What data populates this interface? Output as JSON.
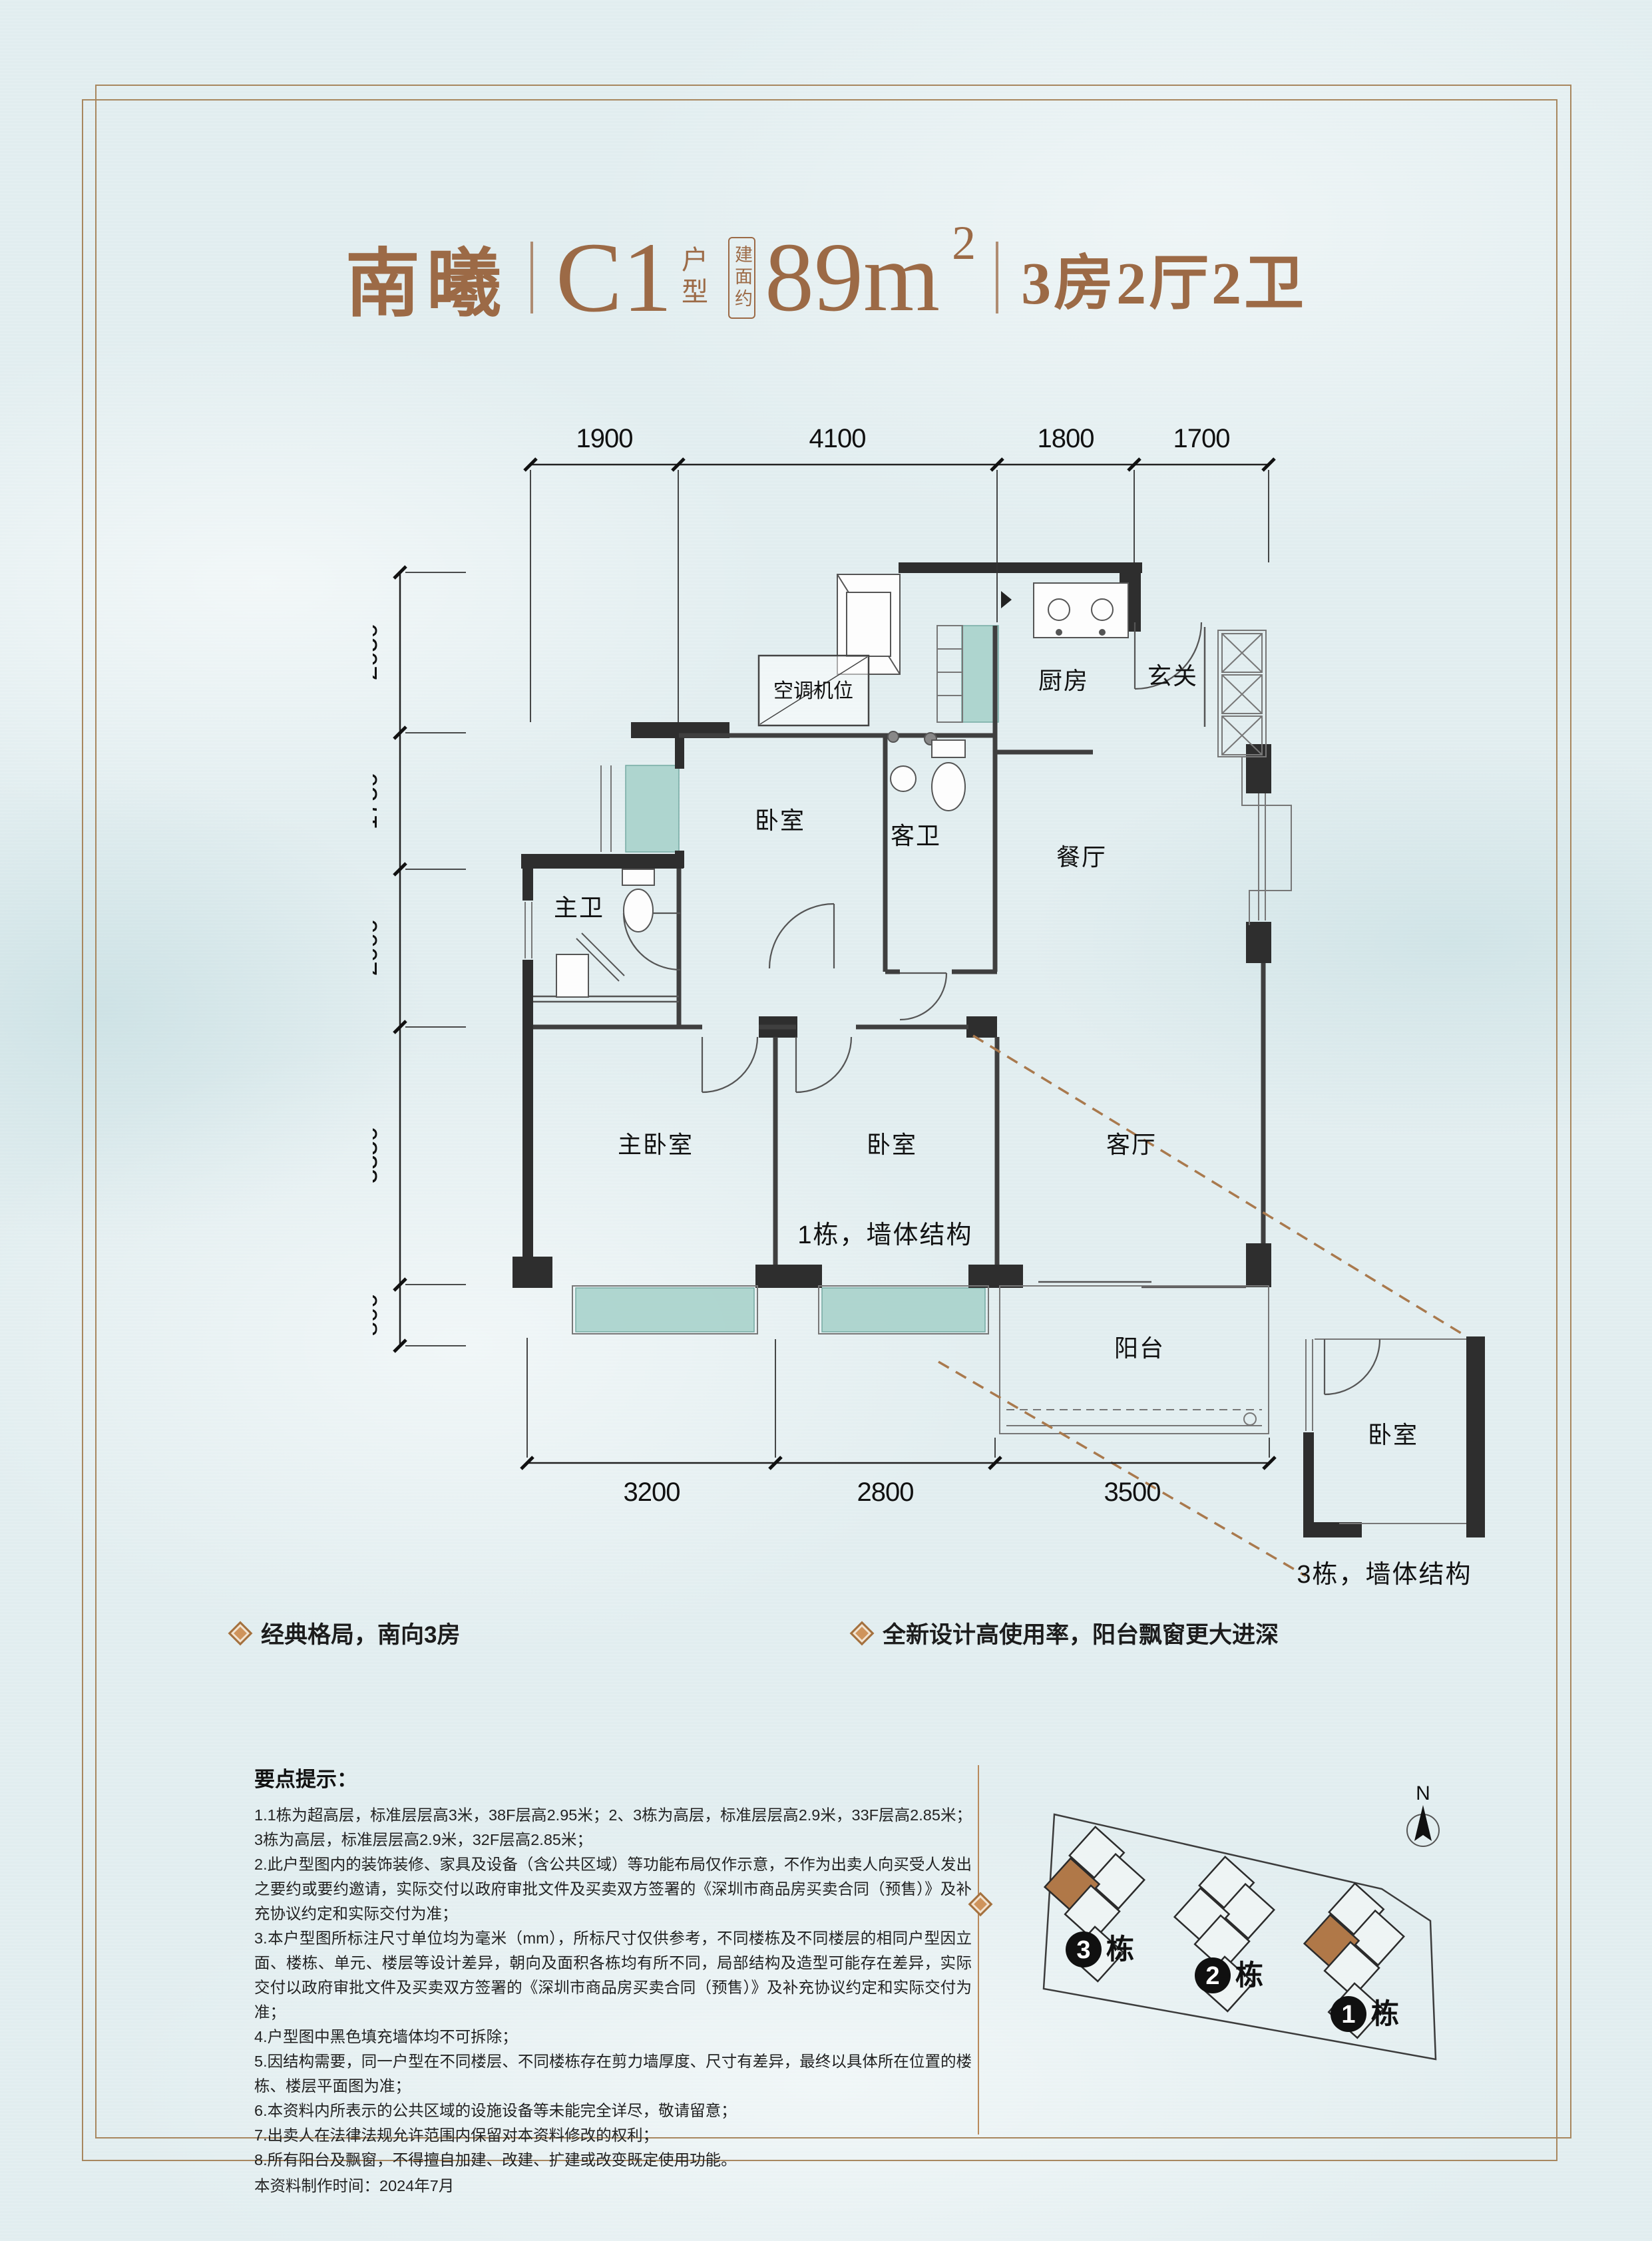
{
  "colors": {
    "accent_brown": "#9c6a46",
    "frame_line": "#a8875f",
    "teal_window": "#a9d3cc",
    "wall_black": "#2e2e2e",
    "dash_leader": "#a9794d",
    "site_highlight": "#b07848"
  },
  "title": {
    "name": "南曦",
    "unit": "C1",
    "unit_suffix": "户型",
    "area_note": "建面约",
    "area": "89m",
    "area_sup": "2",
    "spec": "3房2厅2卫"
  },
  "plan": {
    "dims_top": [
      "1900",
      "4100",
      "1800",
      "1700"
    ],
    "dims_left": [
      "2050",
      "1750",
      "2000",
      "3350",
      "800"
    ],
    "dims_bottom": [
      "3200",
      "2800",
      "3500"
    ],
    "rooms": {
      "ac": "空调机位",
      "kitchen": "厨房",
      "entry": "玄关",
      "bedroom_top": "卧室",
      "guest_bath": "客卫",
      "dining": "餐厅",
      "master_bath": "主卫",
      "master_bedroom": "主卧室",
      "bedroom_mid": "卧室",
      "living": "客厅",
      "balcony": "阳台",
      "detached_bedroom": "卧室"
    },
    "caption_main": "1栋，墙体结构",
    "caption_detached": "3栋，墙体结构"
  },
  "features": [
    {
      "text": "经典格局，南向3房"
    },
    {
      "text": "全新设计高使用率，阳台飘窗更大进深"
    }
  ],
  "notes": {
    "title": "要点提示：",
    "items": [
      "1.1栋为超高层，标准层层高3米，38F层高2.95米；2、3栋为高层，标准层层高2.9米，33F层高2.85米；3栋为高层，标准层层高2.9米，32F层高2.85米；",
      "2.此户型图内的装饰装修、家具及设备（含公共区域）等功能布局仅作示意，不作为出卖人向买受人发出之要约或要约邀请，实际交付以政府审批文件及买卖双方签署的《深圳市商品房买卖合同（预售）》及补充协议约定和实际交付为准；",
      "3.本户型图所标注尺寸单位均为毫米（mm），所标尺寸仅供参考，不同楼栋及不同楼层的相同户型因立面、楼栋、单元、楼层等设计差异，朝向及面积各栋均有所不同，局部结构及造型可能存在差异，实际交付以政府审批文件及买卖双方签署的《深圳市商品房买卖合同（预售）》及补充协议约定和实际交付为准；",
      "4.户型图中黑色填充墙体均不可拆除；",
      "5.因结构需要，同一户型在不同楼层、不同楼栋存在剪力墙厚度、尺寸有差异，最终以具体所在位置的楼栋、楼层平面图为准；",
      "6.本资料内所表示的公共区域的设施设备等未能完全详尽，敬请留意；",
      "7.出卖人在法律法规允许范围内保留对本资料修改的权利；",
      "8.所有阳台及飘窗，不得擅自加建、改建、扩建或改变既定使用功能。"
    ],
    "date_line": "本资料制作时间：2024年7月"
  },
  "siteplan": {
    "north": "N",
    "buildings": [
      {
        "num": "3",
        "suffix": "栋"
      },
      {
        "num": "2",
        "suffix": "栋"
      },
      {
        "num": "1",
        "suffix": "栋"
      }
    ]
  }
}
